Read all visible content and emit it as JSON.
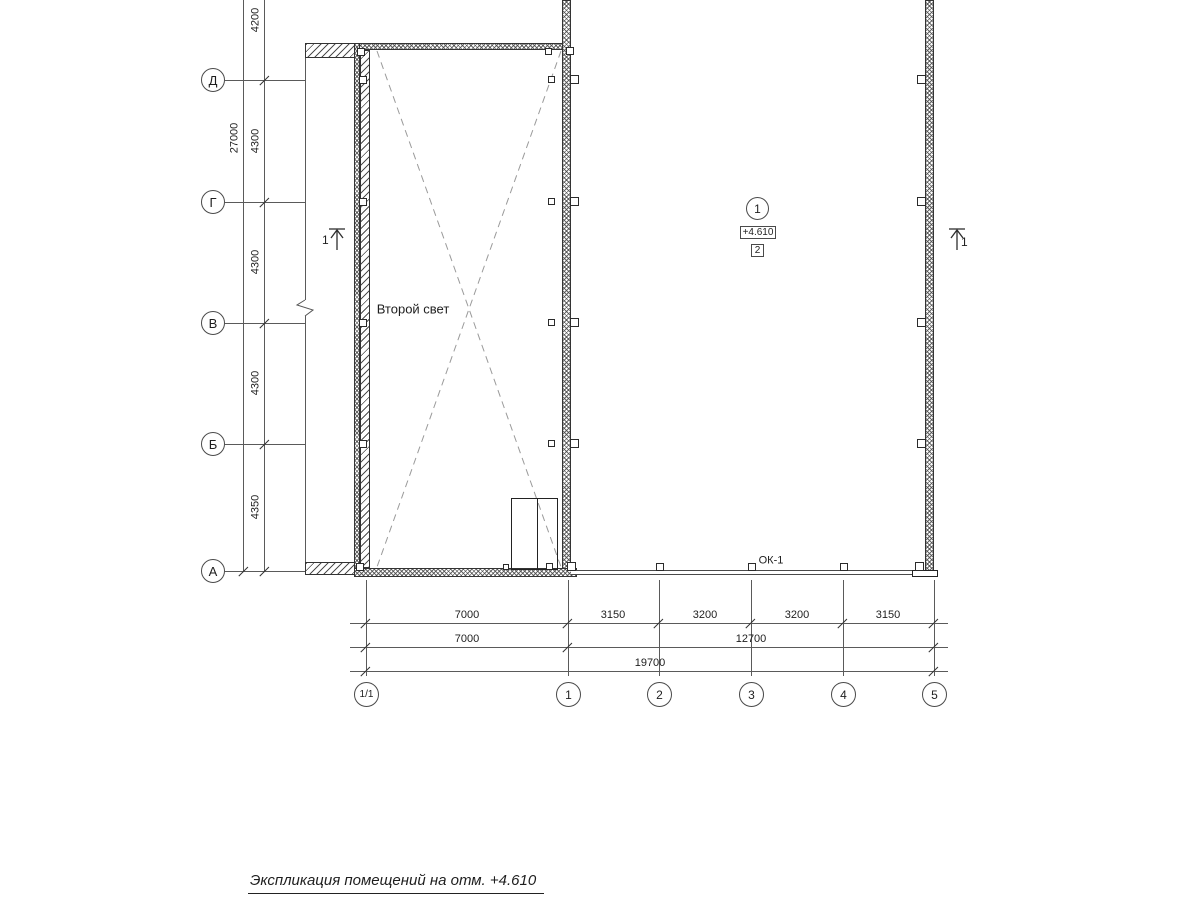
{
  "axes": {
    "left": {
      "total": "27000",
      "segments": [
        "4200",
        "4300",
        "4300",
        "4300",
        "4350"
      ],
      "rows": [
        "Д",
        "Г",
        "В",
        "Б",
        "А"
      ]
    },
    "bottom": {
      "cols": [
        "1/1",
        "1",
        "2",
        "3",
        "4",
        "5"
      ],
      "row1": [
        "7000",
        "3150",
        "3200",
        "3200",
        "3150"
      ],
      "row2": [
        "7000",
        "12700"
      ],
      "row3": [
        "19700"
      ]
    }
  },
  "plan": {
    "second_light": "Второй свет",
    "window_tag": "ОК-1",
    "room": {
      "number": "1",
      "elevation": "+4.610",
      "zone": "2"
    },
    "section_left": "1",
    "section_right": "1"
  },
  "footer": {
    "title": "Экспликация помещений на отм. +4.610"
  }
}
